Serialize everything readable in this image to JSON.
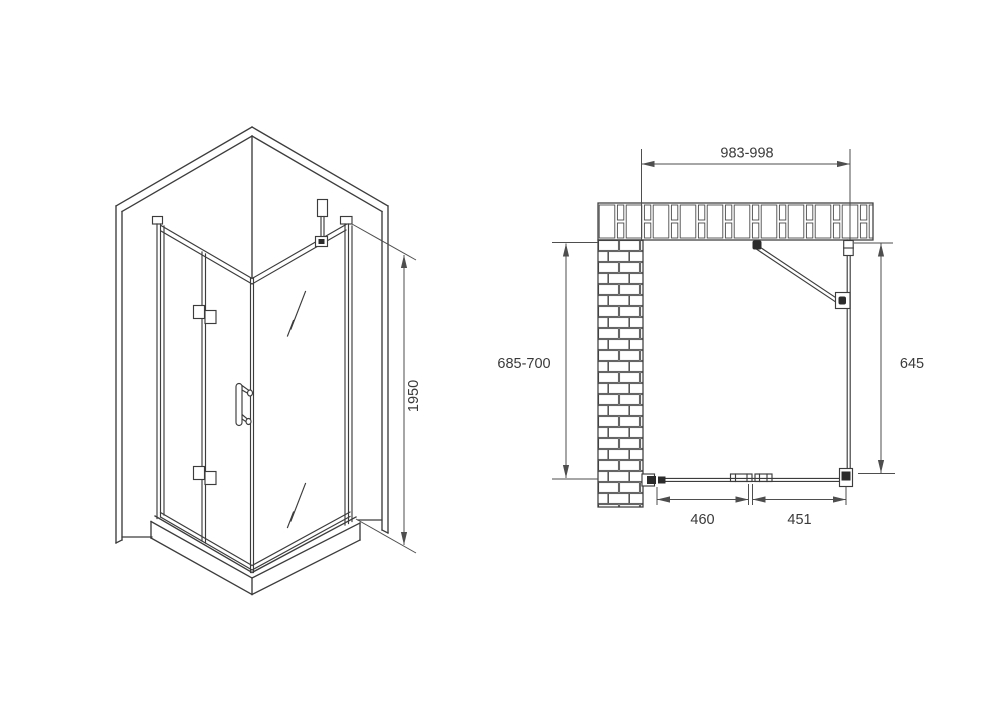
{
  "iso_view": {
    "dims": {
      "height": {
        "label": "1950"
      }
    }
  },
  "plan_view": {
    "dims": {
      "width": {
        "label": "983-998"
      },
      "left_depth": {
        "label": "685-700"
      },
      "right_depth": {
        "label": "645"
      },
      "door_left": {
        "label": "460"
      },
      "door_right": {
        "label": "451"
      }
    }
  },
  "colors": {
    "line": "#3c3c3c",
    "dimension": "#4e4e4e",
    "text": "#3a3a3a",
    "brick_joint": "#4a4a4a",
    "dark_fill": "#2b2b2b",
    "background": "#ffffff"
  }
}
